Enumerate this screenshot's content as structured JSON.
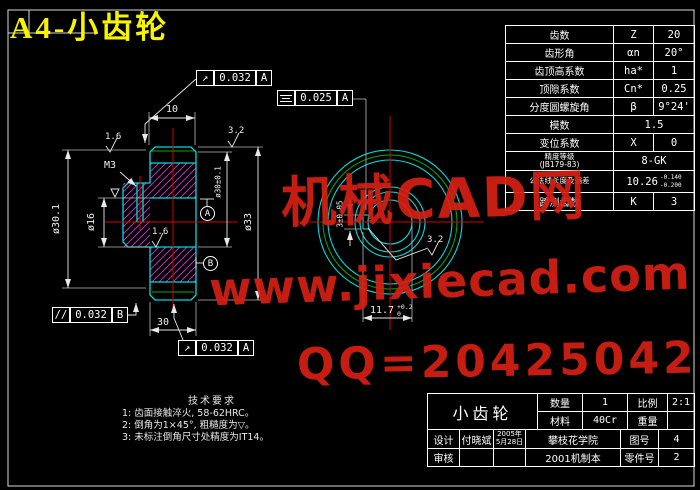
{
  "title": "A4-小齿轮",
  "watermarks": {
    "line1": "机械CAD网",
    "line2": "www.jixiecad.com",
    "line3": "QQ=20425042"
  },
  "colors": {
    "outline": "#00dada",
    "hatch": "#c22ec2",
    "centerline": "#d40000",
    "auxiliary": "#00b000",
    "dimension": "#efefef",
    "title": "#f5f500",
    "watermark": "#d62015"
  },
  "param_table": {
    "rows": [
      {
        "label": "齿数",
        "symbol": "Z",
        "value": "20"
      },
      {
        "label": "齿形角",
        "symbol": "αn",
        "value": "20°"
      },
      {
        "label": "齿顶高系数",
        "symbol": "ha*",
        "value": "1"
      },
      {
        "label": "顶隙系数",
        "symbol": "Cn*",
        "value": "0.25"
      },
      {
        "label": "分度圆螺旋角",
        "symbol": "β",
        "value": "9°24'"
      },
      {
        "label": "模数",
        "value": "1.5"
      },
      {
        "label": "变位系数",
        "symbol": "X",
        "value": "0"
      },
      {
        "label": "精度等级",
        "label2": "(JB179-83)",
        "value": "8-GK"
      },
      {
        "label": "公法线长度及偏差",
        "value": "10.26",
        "tol_upper": "-0.140",
        "tol_lower": "-0.200"
      },
      {
        "label": "跨测齿数",
        "symbol": "K",
        "value": "3"
      }
    ]
  },
  "dimensions": {
    "hub_width": "10",
    "gear_width": "30",
    "thread": "M3",
    "bore_dia": "ø16",
    "shoulder_dia": "ø30.1",
    "hub_dia": "ø30±0.1",
    "outer_dia": "ø33",
    "keyway_width": "3±0.05",
    "keyway_depth": "11.7",
    "keyway_depth_tol_upper": "+0.2",
    "keyway_depth_tol_lower": "0"
  },
  "roughness": {
    "r16": "1.6",
    "r32": "3.2"
  },
  "gdt": {
    "runout_top": {
      "symbol": "↗",
      "value": "0.032",
      "datum": "A"
    },
    "runout_bottom": {
      "symbol": "↗",
      "value": "0.032",
      "datum": "A"
    },
    "parallelism": {
      "symbol": "//",
      "value": "0.032",
      "datum": "B"
    },
    "symmetry": {
      "icon": "symmetry",
      "value": "0.025",
      "datum": "A"
    },
    "datum_a": "A",
    "datum_b": "B"
  },
  "tech_requirements": {
    "heading": "技术要求",
    "line1": "1: 齿面接触淬火, 58-62HRC。",
    "line2": "2: 倒角为1×45°, 粗糙度为▽。",
    "line3": "3: 未标注倒角尺寸处精度为IT14。"
  },
  "title_block": {
    "part_name": "小齿轮",
    "qty_label": "数量",
    "qty": "1",
    "scale_label": "比例",
    "scale": "2:1",
    "material_label": "材料",
    "material": "40Cr",
    "weight_label": "重量",
    "weight": "",
    "design_label": "设计",
    "designer": "付晓斌",
    "date_line1": "2005年",
    "date_line2": "5月28日",
    "school": "攀枝花学院",
    "drawing_no_label": "图号",
    "drawing_no": "4",
    "check_label": "审核",
    "class_name": "2001机制本",
    "part_no_label": "零件号",
    "part_no": "2"
  }
}
